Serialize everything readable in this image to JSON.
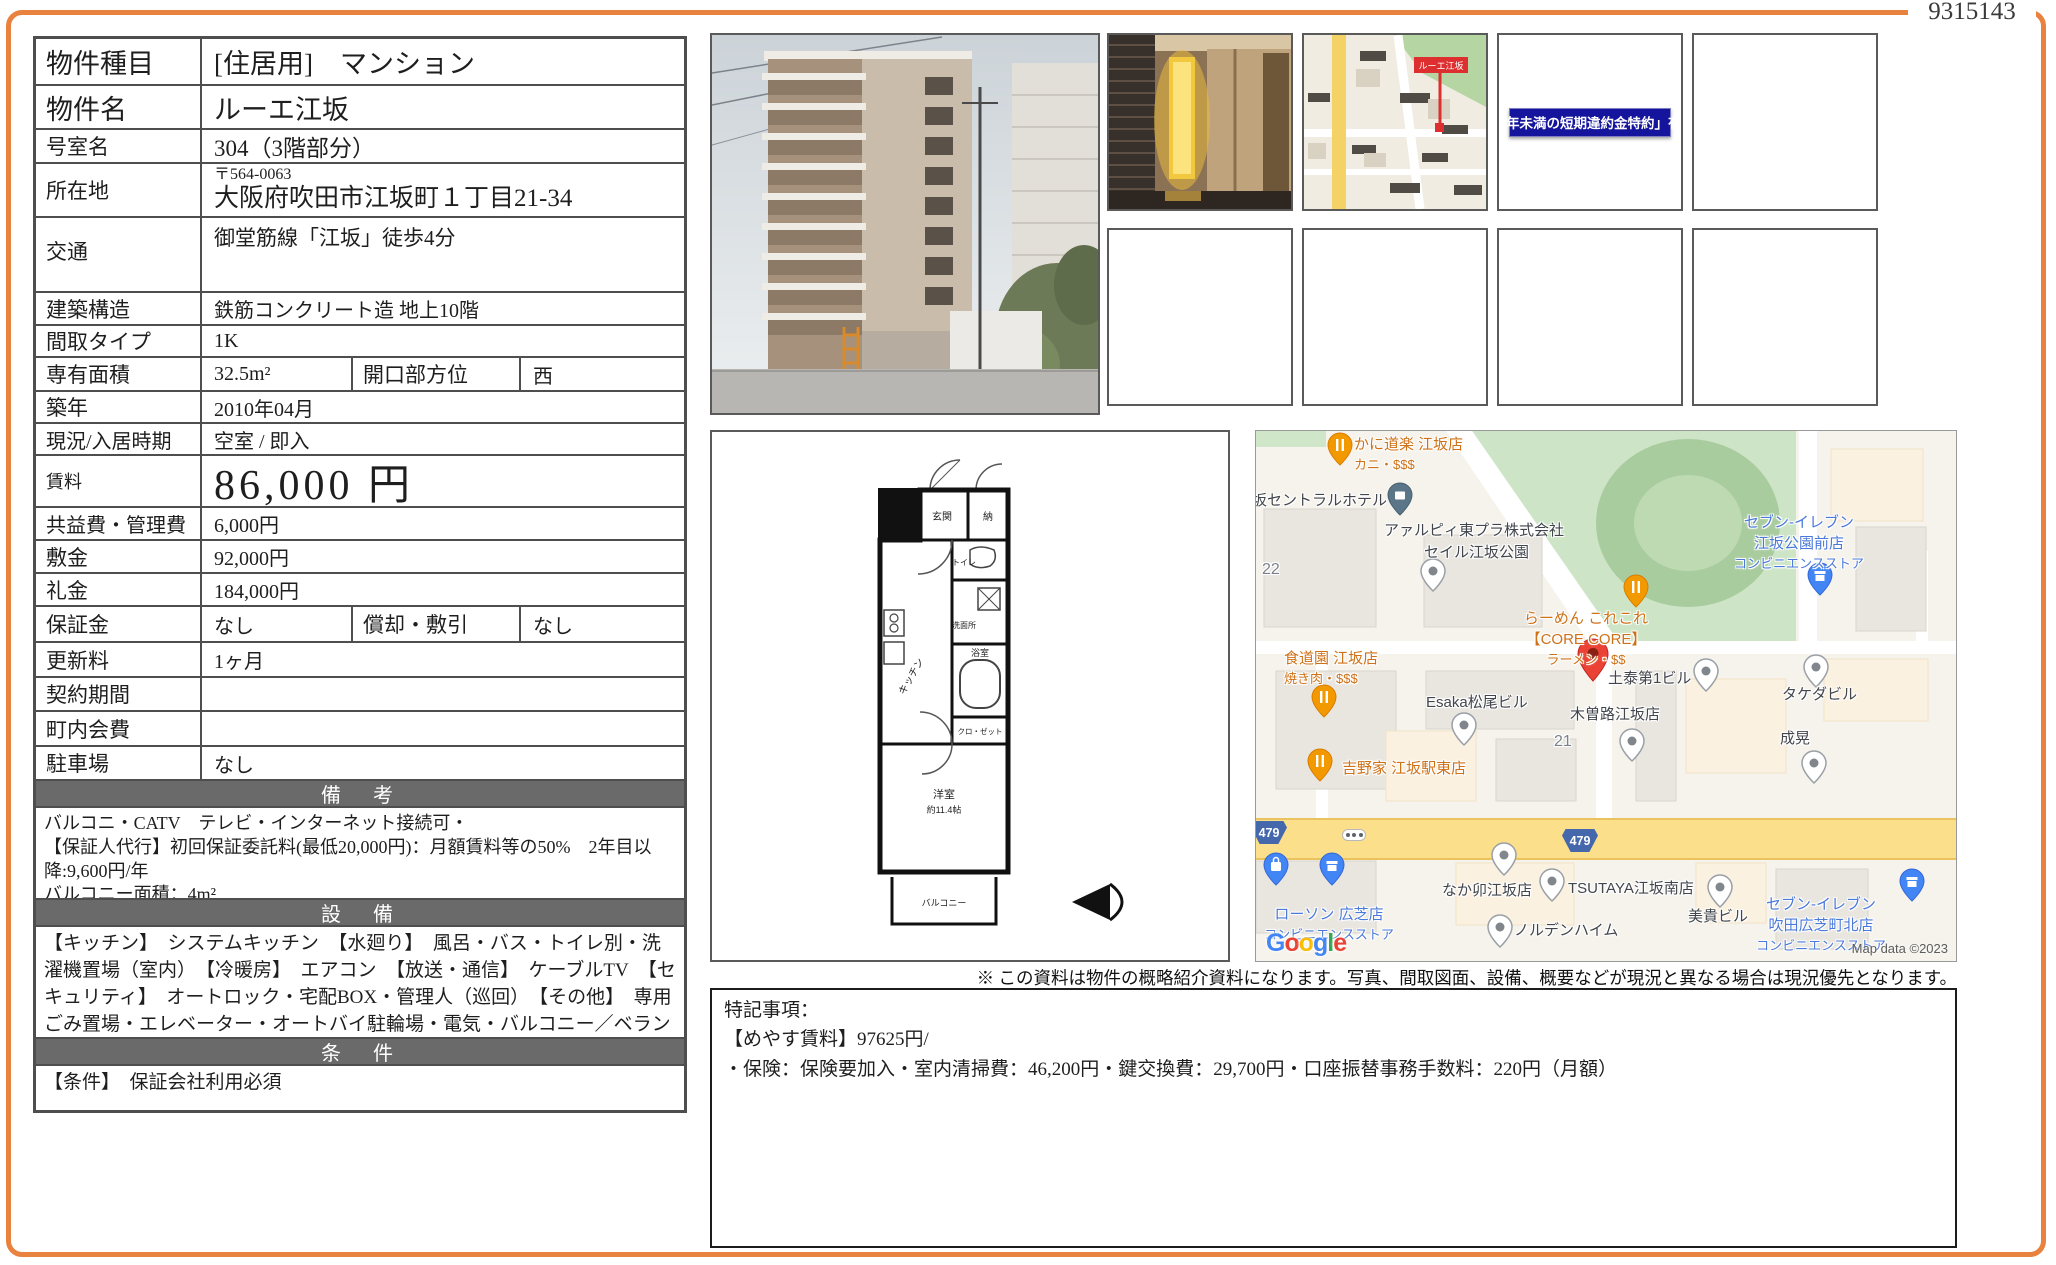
{
  "page": {
    "id_number": "9315143",
    "note": "※ この資料は物件の概略紹介資料になります。写真、間取図面、設備、概要などが現況と異なる場合は現況優先となります。",
    "accent_color": "#e8823e"
  },
  "table": {
    "rows": [
      {
        "label": "物件種目",
        "value": "[住居用]　マンション"
      },
      {
        "label": "物件名",
        "value": "ルーエ江坂"
      },
      {
        "label": "号室名",
        "value": "304（3階部分）"
      },
      {
        "label": "所在地",
        "postal": "〒564-0063",
        "value": "大阪府吹田市江坂町１丁目21-34"
      },
      {
        "label": "交通",
        "value": "御堂筋線「江坂」徒歩4分"
      },
      {
        "label": "建築構造",
        "value": "鉄筋コンクリート造 地上10階"
      },
      {
        "label": "間取タイプ",
        "value": "1K"
      },
      {
        "label": "専有面積",
        "value": "32.5m²",
        "label2": "開口部方位",
        "value2": "西"
      },
      {
        "label": "築年",
        "value": "2010年04月"
      },
      {
        "label": "現況/入居時期",
        "value": "空室 / 即入"
      },
      {
        "label": "賃料",
        "value": "86,000 円"
      },
      {
        "label": "共益費・管理費",
        "value": "6,000円"
      },
      {
        "label": "敷金",
        "value": "92,000円"
      },
      {
        "label": "礼金",
        "value": "184,000円"
      },
      {
        "label": "保証金",
        "value": "なし",
        "label2": "償却・敷引",
        "value2": "なし"
      },
      {
        "label": "更新料",
        "value": "1ヶ月"
      },
      {
        "label": "契約期間",
        "value": ""
      },
      {
        "label": "町内会費",
        "value": ""
      },
      {
        "label": "駐車場",
        "value": "なし"
      }
    ]
  },
  "sections": {
    "biko": {
      "header": "備　考",
      "lines": [
        "バルコニ・CATV　テレビ・インターネット接続可・",
        "【保証人代行】初回保証委託料(最低20,000円)：月額賃料等の50%　2年目以降:9,600円/年",
        "バルコニー面積：4m²"
      ]
    },
    "setsubi": {
      "header": "設　備",
      "text": "【キッチン】　システムキッチン　【水廻り】　風呂・バス・トイレ別・洗濯機置場（室内）　【冷暖房】　エアコン　【放送・通信】　ケーブルTV　【セキュリティ】　オートロック・宅配BOX・管理人（巡回）　【その他】　専用ごみ置場・エレベーター・オートバイ駐輪場・電気・バルコニー／ベランダ"
    },
    "joken": {
      "header": "条　件",
      "text": "【条件】　保証会社利用必須"
    }
  },
  "thumbnails": {
    "map_label": "ルーエ江坂",
    "banner_text": "「1年未満の短期違約金特約」有り"
  },
  "floorplan": {
    "labels": {
      "entrance": "玄関",
      "storage": "納",
      "toilet": "トイレ",
      "washroom": "洗面所",
      "bath": "浴室",
      "kitchen": "キッチン",
      "closet": "クロ・ゼット",
      "room": "洋室",
      "room_size": "約11.4帖",
      "balcony": "バルコニー"
    }
  },
  "map": {
    "route_number": "479",
    "attribution": "Map data ©2023",
    "google_letters": [
      "G",
      "o",
      "o",
      "g",
      "l",
      "e"
    ],
    "block_numbers": [
      "22",
      "21"
    ],
    "pois": [
      {
        "name": "かに道楽 江坂店",
        "sub": "カニ・$$$"
      },
      {
        "name": "坂セントラルホテル"
      },
      {
        "name": "アァルピィ東プラ株式会社"
      },
      {
        "name": "セイル江坂公園"
      },
      {
        "name": "らーめん これこれ",
        "sub": "【CORE CORE】",
        "sub2": "ラーメン・$$"
      },
      {
        "name": "食道園 江坂店",
        "sub": "焼き肉・$$$"
      },
      {
        "name": "Esaka松尾ビル"
      },
      {
        "name": "土泰第1ビル"
      },
      {
        "name": "タケダビル"
      },
      {
        "name": "木曽路江坂店"
      },
      {
        "name": "成晃"
      },
      {
        "name": "セブン-イレブン",
        "sub": "江坂公園前店",
        "sub2": "コンビニエンスストア"
      },
      {
        "name": "吉野家 江坂駅東店"
      },
      {
        "name": "ローソン 広芝店",
        "sub": "コンビニエンスストア"
      },
      {
        "name": "なか卯江坂店"
      },
      {
        "name": "TSUTAYA江坂南店"
      },
      {
        "name": "ノルデンハイム"
      },
      {
        "name": "美貴ビル"
      },
      {
        "name": "セブン-イレブン",
        "sub": "吹田広芝町北店",
        "sub2": "コンビニエンスストア"
      }
    ]
  },
  "tokki": {
    "lines": [
      "特記事項：",
      "【めやす賃料】97625円/",
      "・保険：保険要加入・室内清掃費：46,200円・鍵交換費：29,700円・口座振替事務手数料：220円（月額）"
    ]
  }
}
